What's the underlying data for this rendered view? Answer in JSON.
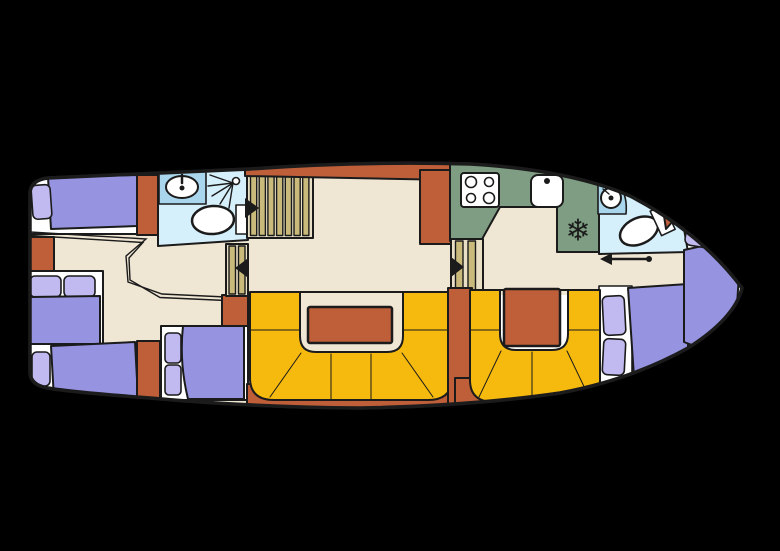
{
  "palette": {
    "background": "#000000",
    "hull": "#ffffff",
    "line": "#1b1b1b",
    "floor": "#f0e6d4",
    "bed": "#9694e1",
    "pillow": "#c0baf0",
    "terracotta": "#bf5f3a",
    "bench": "#f6b90d",
    "galley": "#7e9d82",
    "bath": "#d6f0fb",
    "counter": "#a9d6ec",
    "stair_base": "#e9dfc4",
    "stair_plank": "#c9ba7c"
  },
  "icons": {
    "snowflake": "❄"
  }
}
